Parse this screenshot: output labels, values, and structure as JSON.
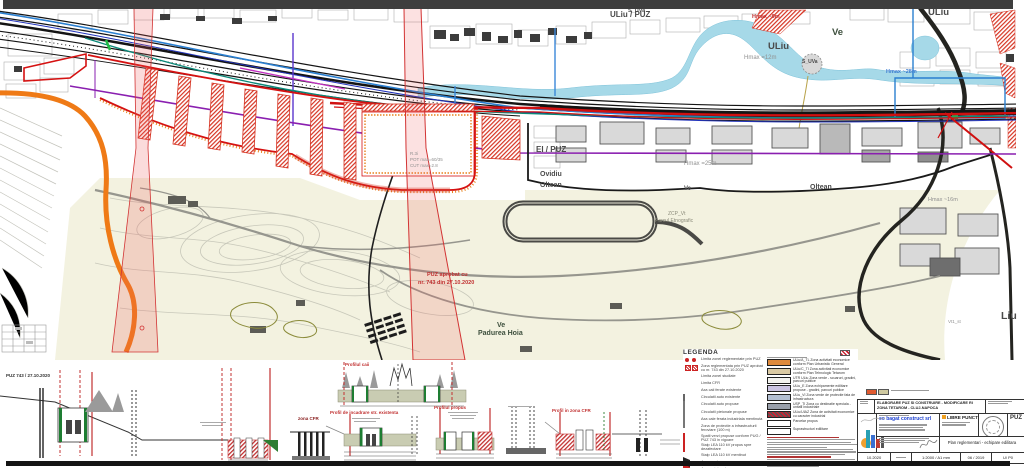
{
  "colors": {
    "top_bar": "#3e3e3e",
    "map_red_road": "#d01010",
    "map_orange_road": "#ef7a16",
    "map_purple_line": "#8a1fb0",
    "map_blue_line": "#2a7fd0",
    "map_teal_line": "#0a8878",
    "river": "#a6d9e8",
    "park": "#f3f2e0",
    "hatch_red": "#d63322"
  },
  "map": {
    "labels": {
      "s_uva_top": "S_UVa",
      "uliu_puz": "ULiu / PUZ",
      "hmax9": "Hmax ~9m",
      "uliu_ne": "ULiu",
      "ve_ne": "Ve",
      "uliu_mid": "ULiu",
      "hmax12": "Hmax =12m",
      "s_uva": "S_UVa",
      "hmax28": "Hmax ~28m",
      "ve_topright": "Ve",
      "ei_puz": "EI / PUZ",
      "hmax25": "Hmax =25m",
      "ovidiu": "Ovidiu",
      "oltean_w": "Oltean",
      "oltean_e": "Oltean",
      "ve_mid": "Ve",
      "zcp_code": "ZCP_Vt",
      "zcp_name": "Parcul Etnografic",
      "puz_line1": "PUZ aprobat cu",
      "puz_line2": "nr. 743 din 27.10.2020",
      "ve_park": "Ve",
      "padurea": "Padurea Hoia",
      "liu": "Liu",
      "hmax16": "Hmax ~16m",
      "r3i_1": "R.3i",
      "r3i_2": "POT max=60/35",
      "r3i_3": "CUT max=2.8",
      "vt1": "Vt1_st"
    }
  },
  "profiles": {
    "note": "PUZ 743 / 27.10.2020",
    "zona_cfr": "zona CFR",
    "caption_top": "Profilul caii",
    "caption_1": "Profil de incadrare str. existenta",
    "caption_2": "Profilul propus",
    "caption_3": "Profil in zona CFR"
  },
  "legend": {
    "title": "LEGENDA",
    "left": [
      {
        "label": "Limita zonei reglementate prin PUZ"
      },
      {
        "label": "Zona reglementata prin PUZ aprobat cu nr. 743 din 27.10.2020"
      },
      {
        "label": "Limita zonei studiate"
      },
      {
        "label": "Limita CFR"
      },
      {
        "label": "Axa caii ferate existente"
      },
      {
        "label": "Circulatii auto existente"
      },
      {
        "label": "Circulatii auto propuse"
      },
      {
        "label": "Circulatii pietonale propuse"
      },
      {
        "label": "Axa cale ferata industriala mentinuta"
      },
      {
        "label": "Zona de protectie a infrastructurii feroviare (100 m)"
      },
      {
        "label": "Spatii verzi propuse conform PUG / PUZ 743 in vigoare"
      },
      {
        "label": "Stalp LEA 110 kV propus spre dezafectare"
      },
      {
        "label": "Stalp LEA 110 kV mentinut"
      },
      {
        "label": "Acces auto"
      },
      {
        "label": "Acces pietonal"
      }
    ],
    "right": [
      {
        "color": "#de8a3c",
        "label": "ULiu/A_TL Zona activitati economice conform Plan Urbanistic General"
      },
      {
        "color": "#d9c9a3",
        "label": "ULiu/C_TI Zona activitati economice conform Plan Tehnologic Tetarom"
      },
      {
        "color": "#f2f2ee",
        "label": "UTR ULiu Zona verde - scuaruri, gradini, parcuri publice"
      },
      {
        "color": "#cbc4e2",
        "label": "ULiu_E Zona echipamente edilitare propuse - gradini, parcuri publice"
      },
      {
        "color": "#b3bfd2",
        "label": "ULiu_VI Zona verde de protectie fata de infrastructura"
      },
      {
        "color": "#9aa0ab",
        "label": "USP_TI Zona cu destinatie speciala - unitati industriale"
      },
      {
        "color": "hatch",
        "label": "ULiu/UIAZ Zona de activitati economice cu caracter industrial"
      },
      {
        "color": "#ffffff",
        "label": "Parcelar propus"
      },
      {
        "color": "#ffffff",
        "label": "Suprastructuri edilitare"
      }
    ]
  },
  "title_block": {
    "project_line1": "ELABORARE PUZ SI CONSTRUIRE - MODIFICARE RI",
    "project_line2": "ZONA TETAROM - CLUJ-NAPOCA",
    "designer_company": "eo bagat construct srl",
    "partner_company": "LIBRE PUNCT",
    "plan_code": "PUZ",
    "plan_title": "Plan reglementari - echipare edilitara",
    "date_small": "10.2020",
    "scale": "1:2000 / A1 mm",
    "date": "06 / 2019",
    "sheet": "U/ P0"
  }
}
